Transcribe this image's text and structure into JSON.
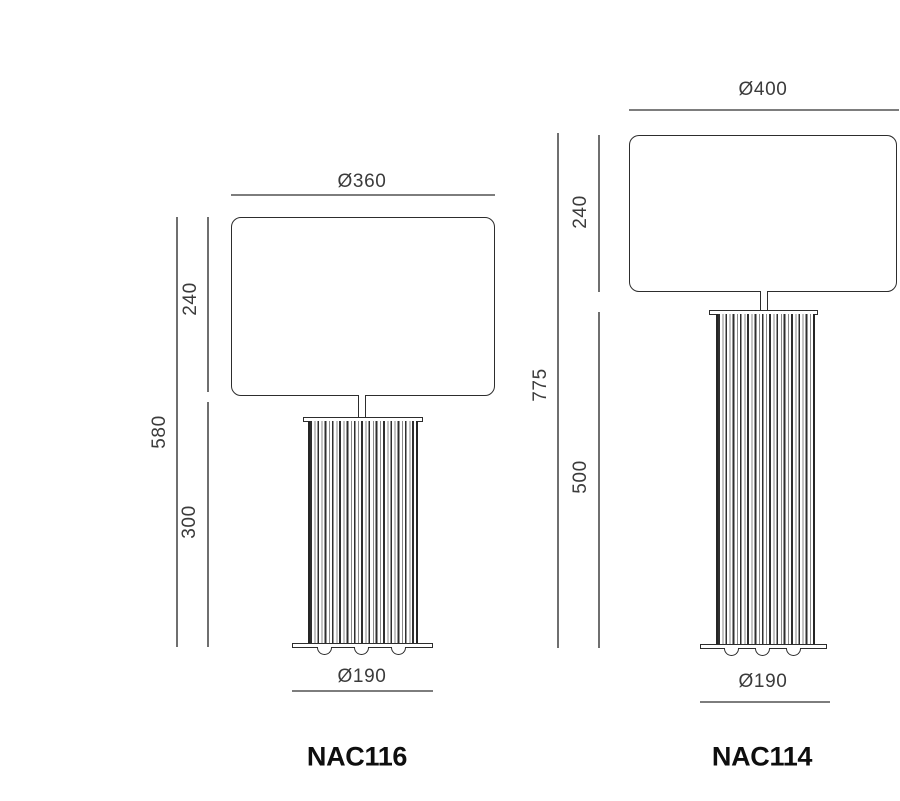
{
  "drawing": {
    "type": "technical-dimension-drawing",
    "units": "mm",
    "background_color": "#ffffff",
    "line_color_dimension": "#7d7d7d",
    "line_color_outline": "#2d2d2d",
    "text_color_dimension": "#3b3b3b",
    "text_color_model": "#0e0e0e"
  },
  "lamps": [
    {
      "model": "NAC116",
      "shade_diameter": "Ø360",
      "shade_height": "240",
      "total_height": "580",
      "column_height": "300",
      "base_diameter": "Ø190"
    },
    {
      "model": "NAC114",
      "shade_diameter": "Ø400",
      "shade_height": "240",
      "total_height": "775",
      "column_height": "500",
      "base_diameter": "Ø190"
    }
  ]
}
